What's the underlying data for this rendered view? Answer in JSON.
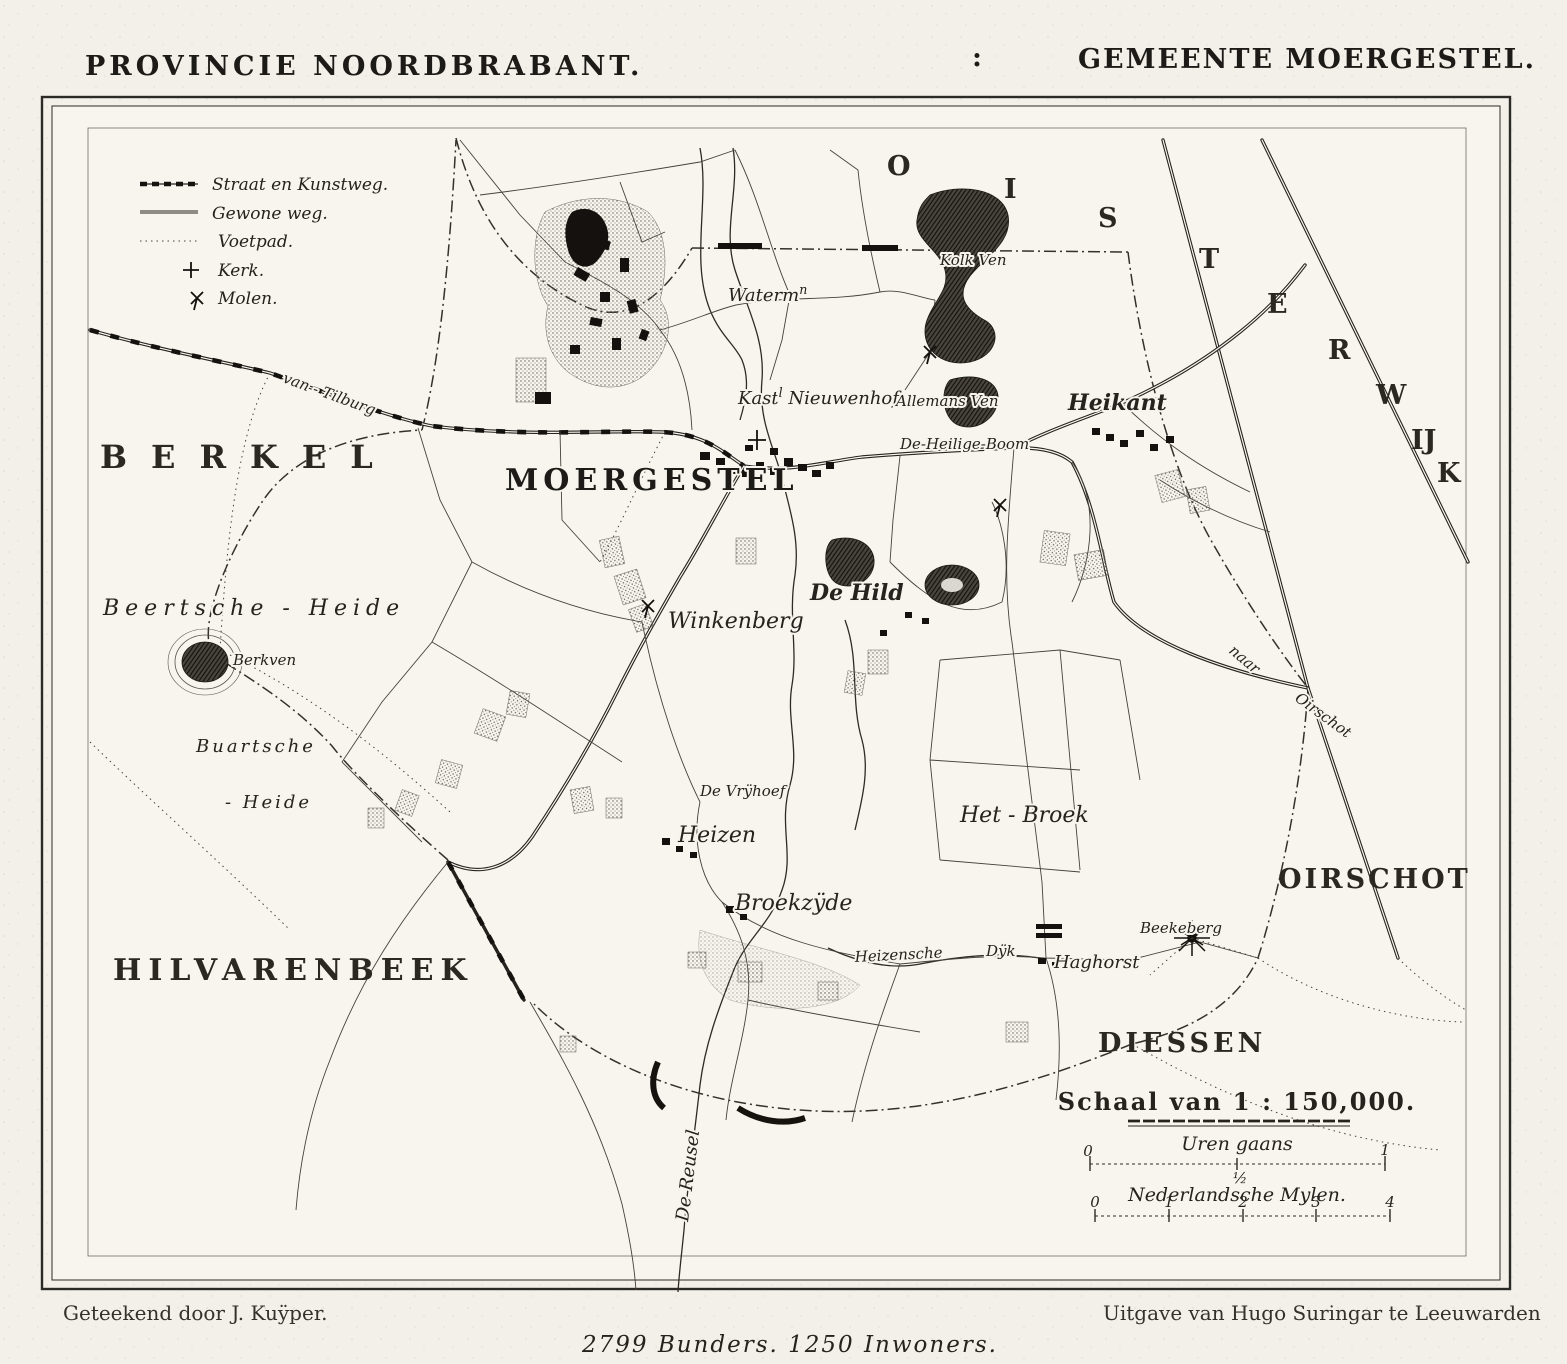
{
  "header": {
    "left_title": "PROVINCIE NOORDBRABANT.",
    "separator": ":",
    "right_title": "GEMEENTE MOERGESTEL."
  },
  "legend": {
    "straat": "Straat en Kunstweg.",
    "gewone": "Gewone weg.",
    "voetpad": "Voetpad.",
    "kerk": "Kerk.",
    "molen": "Molen."
  },
  "regions": {
    "berkel": "BERKEL",
    "hilvarenbeek": "HILVARENBEEK",
    "oirschot": "OIRSCHOT",
    "diessen": "DIESSEN",
    "oisterwijk_letters": [
      "O",
      "I",
      "S",
      "T",
      "E",
      "R",
      "W",
      "IJ",
      "K"
    ]
  },
  "places": {
    "moergestel": "MOERGESTEL",
    "heikant": "Heikant",
    "waterm_base": "Waterm",
    "waterm_sup": "n",
    "kasteel_base": "Kast",
    "kasteel_sup": "l",
    "kasteel_rest": " Nieuwenhof",
    "allemans_ven": "Allemans Ven",
    "de_heilige_boom": "De-Heilige-Boom",
    "kolk_ven": "Kolk Ven",
    "de_hild": "De Hild",
    "winkenberg": "Winkenberg",
    "beertsche_heide": "Beertsche - Heide",
    "berkven": "Berkven",
    "buartsche": "Buartsche",
    "buartsche_heide2": "- Heide",
    "de_vrijhoef": "De Vrÿhoef",
    "heizen": "Heizen",
    "broekzijde": "Broekzÿde",
    "het_broek": "Het - Broek",
    "heizensche": "Heizensche",
    "dijk": "Dÿk",
    "haghorst": "Haghorst",
    "beekeberg": "Beekeberg",
    "van_tilburg": "van - Tilburg",
    "naar": "naar",
    "naar_oirschot": "Oirschot",
    "de_reusel": "De Reusel"
  },
  "scale": {
    "title": "Schaal van 1 : 150,000.",
    "uren_label": "Uren gaans",
    "uren_start": "0",
    "uren_half": "½",
    "uren_end": "1",
    "mijlen_label": "Nederlandsche Mylen.",
    "mijlen_ticks": [
      "0",
      "1",
      "2",
      "3",
      "4"
    ]
  },
  "footer": {
    "left": "Geteekend door J. Kuÿper.",
    "center": "2799 Bunders.  1250 Inwoners.",
    "right": "Uitgave van Hugo Suringar te Leeuwarden"
  },
  "colors": {
    "paper": "#f2f0e9",
    "ink": "#26231f"
  }
}
